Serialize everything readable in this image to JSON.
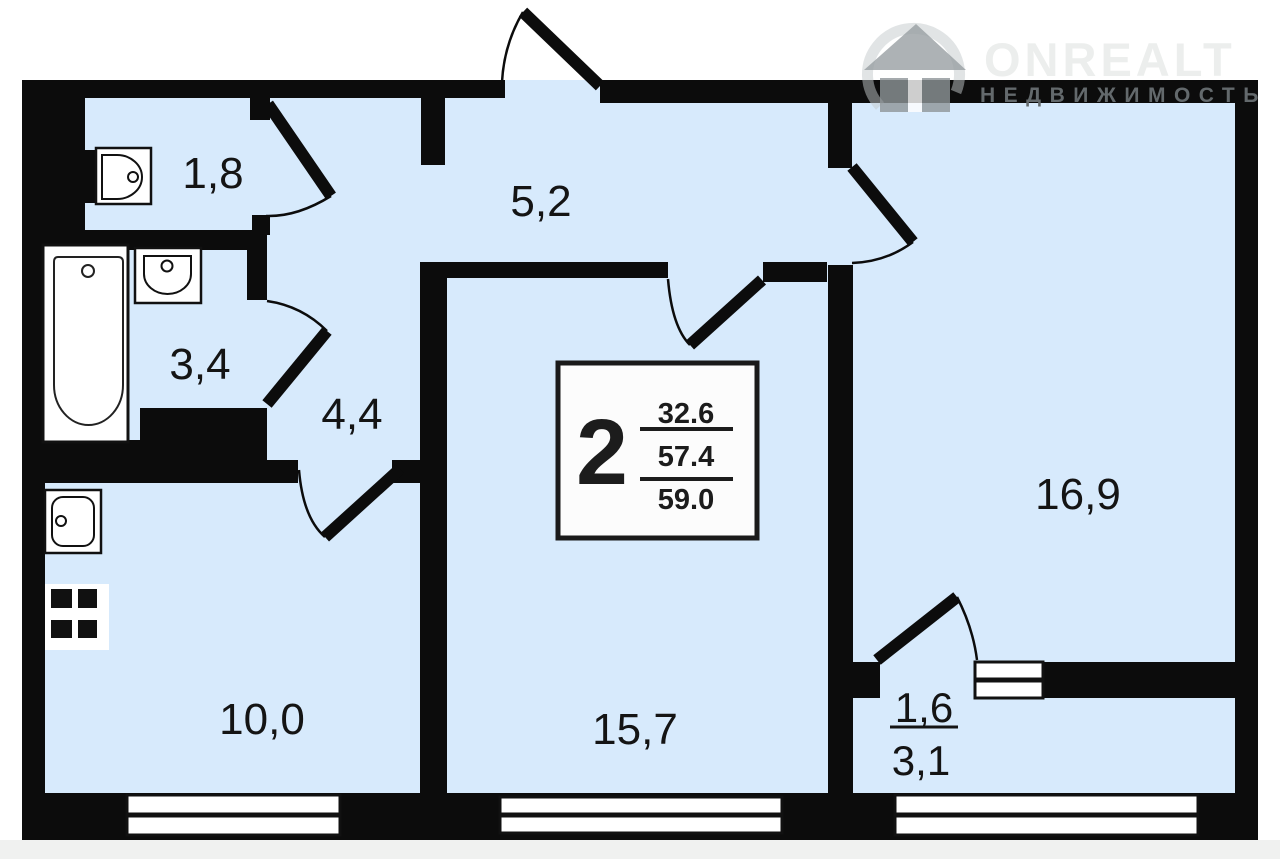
{
  "logo": {
    "brand": "ONREALT",
    "tagline": "НЕДВИЖИМОСТЬ"
  },
  "info_box": {
    "room_count": "2",
    "living_area": "32.6",
    "area_secondary": "57.4",
    "total_area": "59.0"
  },
  "rooms": {
    "wc": {
      "name": "wc",
      "area": "1,8"
    },
    "hall_upper": {
      "name": "hallway-upper",
      "area": "5,2"
    },
    "bathroom": {
      "name": "bathroom",
      "area": "3,4"
    },
    "hall_lower": {
      "name": "hallway-lower",
      "area": "4,4"
    },
    "kitchen": {
      "name": "kitchen",
      "area": "10,0"
    },
    "living_room": {
      "name": "living-room",
      "area": "15,7"
    },
    "bedroom": {
      "name": "bedroom",
      "area": "16,9"
    },
    "balcony": {
      "name": "balcony",
      "area_reduced": "1,6",
      "area_full": "3,1"
    }
  },
  "fixtures": [
    "toilet",
    "bathtub",
    "washbasin",
    "kitchen-sink",
    "stove"
  ],
  "colors": {
    "floor": "#d7eafc",
    "wall": "#0c0c0c",
    "page": "#ffffff",
    "bottom_margin": "#f0f1f0",
    "info_box_bg": "#fcfcfc",
    "watermark_light": "#eceeed",
    "watermark_dark": "#63696c"
  }
}
